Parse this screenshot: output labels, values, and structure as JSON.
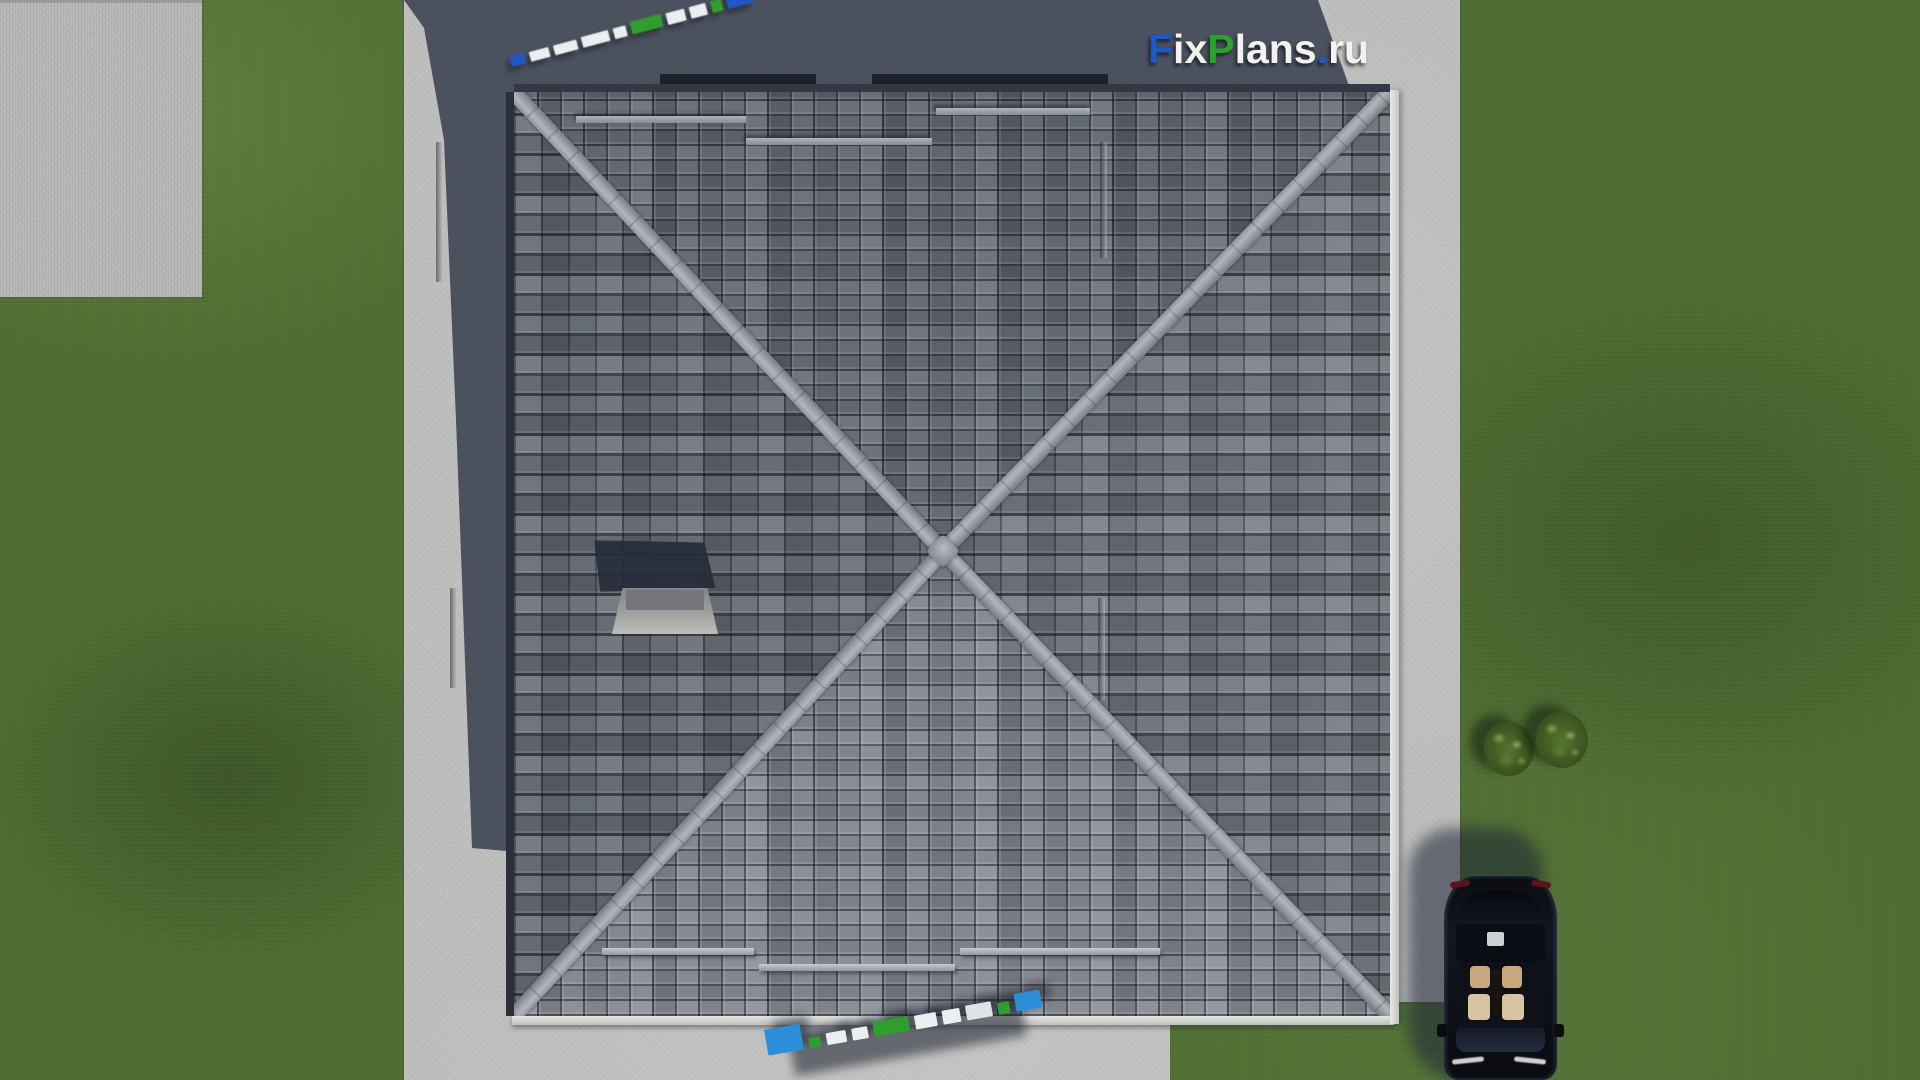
{
  "meta": {
    "type": "3d-aerial-render",
    "subject": "Top-down render of a house with pyramidal hip roof, concrete walkway, driveway with parked car, lawn and two bushes"
  },
  "brand": {
    "site": "FixPlans.ru",
    "logo_parts": [
      {
        "text": "F",
        "color": "#1e58c8"
      },
      {
        "text": "ix",
        "color": "#f2f3f1"
      },
      {
        "text": "P",
        "color": "#2ba32b"
      },
      {
        "text": "lans",
        "color": "#f2f3f1"
      },
      {
        "text": ".",
        "color": "#1e58c8"
      },
      {
        "text": "ru",
        "color": "#f2f3f1"
      }
    ]
  },
  "watermarks": {
    "top": {
      "desc": "blurred 3D FixPlans.ru logo lying on shadowed concrete, rotated",
      "blocks": [
        {
          "w": 15,
          "h": 11,
          "c": "#2255c5"
        },
        {
          "w": 20,
          "h": 10,
          "c": "#eceff0"
        },
        {
          "w": 24,
          "h": 10,
          "c": "#eceff0"
        },
        {
          "w": 28,
          "h": 11,
          "c": "#eceff0"
        },
        {
          "w": 13,
          "h": 11,
          "c": "#eceff0"
        },
        {
          "w": 32,
          "h": 13,
          "c": "#2f9e2d"
        },
        {
          "w": 19,
          "h": 12,
          "c": "#eceff0"
        },
        {
          "w": 17,
          "h": 12,
          "c": "#eceff0"
        },
        {
          "w": 11,
          "h": 12,
          "c": "#2f9e2d"
        },
        {
          "w": 26,
          "h": 17,
          "c": "#2255c5"
        }
      ]
    },
    "bottom": {
      "desc": "3D FixPlans.ru logo on sunlit concrete, cut off by bottom edge",
      "blocks": [
        {
          "w": 36,
          "h": 26,
          "c": "#2b8ed6"
        },
        {
          "w": 12,
          "h": 10,
          "c": "#2f9e2d"
        },
        {
          "w": 20,
          "h": 12,
          "c": "#eceff0"
        },
        {
          "w": 16,
          "h": 12,
          "c": "#eceff0"
        },
        {
          "w": 36,
          "h": 15,
          "c": "#2f9e2d"
        },
        {
          "w": 22,
          "h": 14,
          "c": "#eceff0"
        },
        {
          "w": 18,
          "h": 14,
          "c": "#eceff0"
        },
        {
          "w": 26,
          "h": 15,
          "c": "#dfe3e4"
        },
        {
          "w": 12,
          "h": 12,
          "c": "#2f9e2d"
        },
        {
          "w": 26,
          "h": 18,
          "c": "#2b8ed6"
        }
      ]
    }
  },
  "palette": {
    "grass": "#4e6e33",
    "concrete": "#bebebc",
    "concrete_shadow": "#2b3244",
    "roof_tile_mid": "#6b7078",
    "ridge": "#a7abb1",
    "gutter": "#e2e2df",
    "chimney": "#9b9c9a",
    "car_body": "#0d1016",
    "car_interior": "#c8a87e",
    "bush": "#55742f",
    "logo_blue": "#1e58c8",
    "logo_green": "#2ba32b",
    "logo_white": "#f2f3f1"
  }
}
